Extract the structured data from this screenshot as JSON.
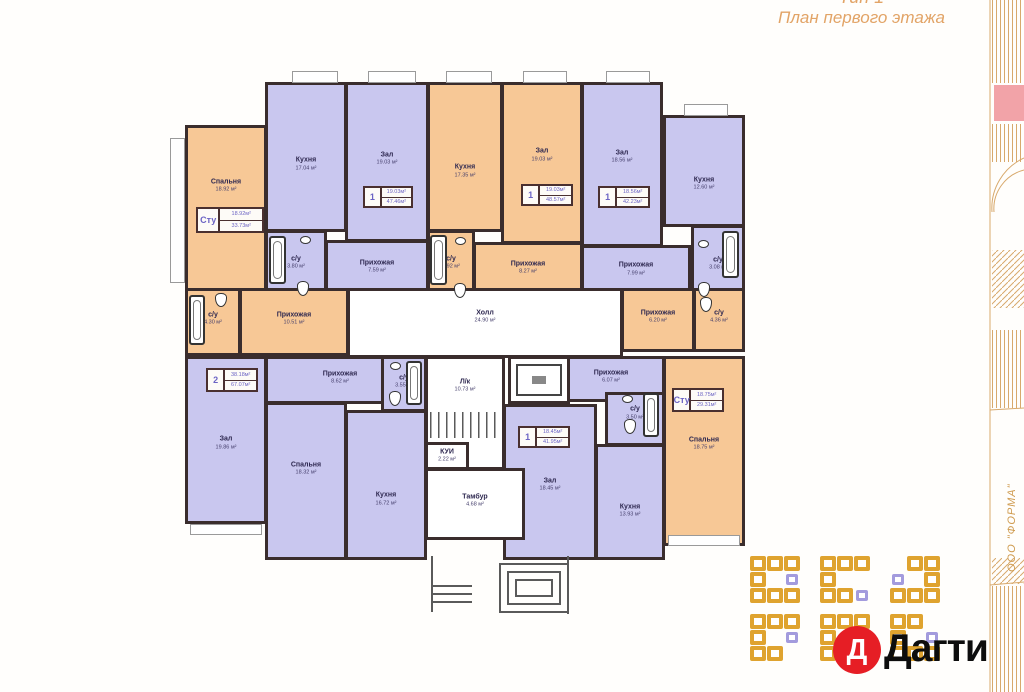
{
  "title": {
    "type_label": "Тип 1",
    "plan_label": "План первого этажа"
  },
  "frame": {
    "company": "ООО \"ФОРМА\""
  },
  "logo": {
    "letter": "Д",
    "name": "Дагти"
  },
  "colors": {
    "room_purple": "#c9c7ef",
    "room_orange": "#f7c896",
    "wall": "#3a2d2d",
    "title_orange": "#e2a467",
    "logo_red": "#e61e25",
    "frame_line": "#d8a96c",
    "frame_pink": "#f2a3a8",
    "unit_text": "#6b63c4"
  },
  "plan": {
    "rooms": [
      {
        "name": "Спальня",
        "area": "18.92 м²",
        "color": "orange",
        "x": 185,
        "y": 125,
        "w": 82,
        "h": 172,
        "ly": 0.35
      },
      {
        "name": "Кухня",
        "area": "17.04 м²",
        "color": "purple",
        "x": 265,
        "y": 82,
        "w": 82,
        "h": 150,
        "ly": 0.55
      },
      {
        "name": "Зал",
        "area": "19.03 м²",
        "color": "purple",
        "x": 345,
        "y": 82,
        "w": 84,
        "h": 160,
        "ly": 0.48
      },
      {
        "name": "Кухня",
        "area": "17.35 м²",
        "color": "orange",
        "x": 427,
        "y": 82,
        "w": 76,
        "h": 150,
        "ly": 0.6
      },
      {
        "name": "Зал",
        "area": "19.03 м²",
        "color": "orange",
        "x": 501,
        "y": 82,
        "w": 82,
        "h": 162,
        "ly": 0.45
      },
      {
        "name": "Зал",
        "area": "18.56 м²",
        "color": "purple",
        "x": 581,
        "y": 82,
        "w": 82,
        "h": 165,
        "ly": 0.45
      },
      {
        "name": "Кухня",
        "area": "12.60 м²",
        "color": "purple",
        "x": 663,
        "y": 115,
        "w": 82,
        "h": 112,
        "ly": 0.62
      },
      {
        "name": "с/у",
        "area": "3.80 м²",
        "color": "purple",
        "x": 265,
        "y": 230,
        "w": 62,
        "h": 72,
        "ly": 0.45
      },
      {
        "name": "Прихожая",
        "area": "7.59 м²",
        "color": "purple",
        "x": 325,
        "y": 240,
        "w": 104,
        "h": 62,
        "ly": 0.42
      },
      {
        "name": "с/у",
        "area": "3.92 м²",
        "color": "orange",
        "x": 427,
        "y": 230,
        "w": 48,
        "h": 72,
        "ly": 0.45
      },
      {
        "name": "Прихожая",
        "area": "8.27 м²",
        "color": "orange",
        "x": 473,
        "y": 242,
        "w": 110,
        "h": 60,
        "ly": 0.42
      },
      {
        "name": "Прихожая",
        "area": "7.99 м²",
        "color": "purple",
        "x": 581,
        "y": 245,
        "w": 110,
        "h": 57,
        "ly": 0.42
      },
      {
        "name": "с/у",
        "area": "3.08 м²",
        "color": "purple",
        "x": 691,
        "y": 225,
        "w": 54,
        "h": 77,
        "ly": 0.5
      },
      {
        "name": "с/у",
        "area": "4.30 м²",
        "color": "orange",
        "x": 185,
        "y": 288,
        "w": 56,
        "h": 68,
        "ly": 0.45
      },
      {
        "name": "Прихожая",
        "area": "10.51 м²",
        "color": "orange",
        "x": 239,
        "y": 288,
        "w": 110,
        "h": 68,
        "ly": 0.45
      },
      {
        "name": "Холл",
        "area": "24.90 м²",
        "color": "white",
        "x": 347,
        "y": 288,
        "w": 276,
        "h": 70,
        "ly": 0.4
      },
      {
        "name": "Прихожая",
        "area": "6.20 м²",
        "color": "orange",
        "x": 621,
        "y": 288,
        "w": 74,
        "h": 64,
        "ly": 0.45
      },
      {
        "name": "с/у",
        "area": "4.36 м²",
        "color": "orange",
        "x": 693,
        "y": 288,
        "w": 52,
        "h": 64,
        "ly": 0.45
      },
      {
        "name": "Зал",
        "area": "19.86 м²",
        "color": "purple",
        "x": 185,
        "y": 356,
        "w": 82,
        "h": 168,
        "ly": 0.52
      },
      {
        "name": "Прихожая",
        "area": "8.62 м²",
        "color": "purple",
        "x": 265,
        "y": 356,
        "w": 150,
        "h": 48,
        "ly": 0.45
      },
      {
        "name": "с/у",
        "area": "3.55 м²",
        "color": "purple",
        "x": 381,
        "y": 356,
        "w": 46,
        "h": 56,
        "ly": 0.45
      },
      {
        "name": "Спальня",
        "area": "18.32 м²",
        "color": "purple",
        "x": 265,
        "y": 402,
        "w": 82,
        "h": 158,
        "ly": 0.42
      },
      {
        "name": "Кухня",
        "area": "16.72 м²",
        "color": "purple",
        "x": 345,
        "y": 410,
        "w": 82,
        "h": 150,
        "ly": 0.6
      },
      {
        "name": "Л/к",
        "area": "10.73 м²",
        "color": "white",
        "x": 425,
        "y": 356,
        "w": 80,
        "h": 114,
        "ly": 0.25
      },
      {
        "name": "Прихожая",
        "area": "6.07 м²",
        "color": "purple",
        "x": 557,
        "y": 356,
        "w": 108,
        "h": 46,
        "ly": 0.45
      },
      {
        "name": "с/у",
        "area": "3.50 м²",
        "color": "purple",
        "x": 605,
        "y": 392,
        "w": 60,
        "h": 54,
        "ly": 0.38
      },
      {
        "name": "Зал",
        "area": "18.45 м²",
        "color": "purple",
        "x": 503,
        "y": 404,
        "w": 94,
        "h": 156,
        "ly": 0.52
      },
      {
        "name": "Кухня",
        "area": "13.93 м²",
        "color": "purple",
        "x": 595,
        "y": 444,
        "w": 70,
        "h": 116,
        "ly": 0.58
      },
      {
        "name": "Спальня",
        "area": "18.75 м²",
        "color": "orange",
        "x": 663,
        "y": 356,
        "w": 82,
        "h": 190,
        "ly": 0.46
      },
      {
        "name": "КУИ",
        "area": "2.22 м²",
        "color": "white",
        "x": 425,
        "y": 442,
        "w": 44,
        "h": 28,
        "ly": 0.5
      },
      {
        "name": "Тамбур",
        "area": "4.68 м²",
        "color": "white",
        "x": 425,
        "y": 468,
        "w": 100,
        "h": 72,
        "ly": 0.45
      }
    ],
    "unit_boxes": [
      {
        "label": "Сту",
        "a1": "18.92м²",
        "a2": "33.73м²",
        "x": 196,
        "y": 207,
        "w": 68,
        "h": 26
      },
      {
        "label": "1",
        "a1": "19.03м²",
        "a2": "47.46м²",
        "x": 363,
        "y": 186,
        "w": 50,
        "h": 22
      },
      {
        "label": "1",
        "a1": "19.03м²",
        "a2": "48.57м²",
        "x": 521,
        "y": 184,
        "w": 52,
        "h": 22
      },
      {
        "label": "1",
        "a1": "18.56м²",
        "a2": "42.23м²",
        "x": 598,
        "y": 186,
        "w": 52,
        "h": 22
      },
      {
        "label": "2",
        "a1": "38.18м²",
        "a2": "67.07м²",
        "x": 206,
        "y": 368,
        "w": 52,
        "h": 24
      },
      {
        "label": "1",
        "a1": "18.45м²",
        "a2": "41.95м²",
        "x": 518,
        "y": 426,
        "w": 52,
        "h": 22
      },
      {
        "label": "Сту",
        "a1": "18.75м²",
        "a2": "29.31м²",
        "x": 672,
        "y": 388,
        "w": 52,
        "h": 24
      }
    ],
    "fixtures": [
      {
        "type": "tub",
        "x": 269,
        "y": 236,
        "w": 17,
        "h": 48
      },
      {
        "type": "tub",
        "x": 430,
        "y": 235,
        "w": 17,
        "h": 50
      },
      {
        "type": "tub",
        "x": 722,
        "y": 231,
        "w": 17,
        "h": 47
      },
      {
        "type": "tub",
        "x": 189,
        "y": 295,
        "w": 16,
        "h": 50
      },
      {
        "type": "tub",
        "x": 406,
        "y": 361,
        "w": 16,
        "h": 44
      },
      {
        "type": "tub",
        "x": 643,
        "y": 393,
        "w": 16,
        "h": 44
      },
      {
        "type": "toilet",
        "x": 297,
        "y": 281,
        "w": 12,
        "h": 15
      },
      {
        "type": "toilet",
        "x": 454,
        "y": 283,
        "w": 12,
        "h": 15
      },
      {
        "type": "toilet",
        "x": 698,
        "y": 282,
        "w": 12,
        "h": 15
      },
      {
        "type": "toilet",
        "x": 215,
        "y": 293,
        "w": 12,
        "h": 14
      },
      {
        "type": "toilet",
        "x": 389,
        "y": 391,
        "w": 12,
        "h": 15
      },
      {
        "type": "toilet",
        "x": 624,
        "y": 419,
        "w": 12,
        "h": 15
      },
      {
        "type": "toilet",
        "x": 700,
        "y": 297,
        "w": 12,
        "h": 15
      },
      {
        "type": "sink",
        "x": 300,
        "y": 236,
        "w": 11,
        "h": 8
      },
      {
        "type": "sink",
        "x": 455,
        "y": 237,
        "w": 11,
        "h": 8
      },
      {
        "type": "sink",
        "x": 698,
        "y": 240,
        "w": 11,
        "h": 8
      },
      {
        "type": "sink",
        "x": 390,
        "y": 362,
        "w": 11,
        "h": 8
      },
      {
        "type": "sink",
        "x": 622,
        "y": 395,
        "w": 11,
        "h": 8
      }
    ],
    "windows": [
      {
        "x": 292,
        "y": 71,
        "w": 46,
        "h": 12
      },
      {
        "x": 368,
        "y": 71,
        "w": 48,
        "h": 12
      },
      {
        "x": 446,
        "y": 71,
        "w": 46,
        "h": 12
      },
      {
        "x": 523,
        "y": 71,
        "w": 44,
        "h": 12
      },
      {
        "x": 606,
        "y": 71,
        "w": 44,
        "h": 12
      },
      {
        "x": 684,
        "y": 104,
        "w": 44,
        "h": 12
      },
      {
        "x": 170,
        "y": 138,
        "w": 15,
        "h": 145
      },
      {
        "x": 190,
        "y": 524,
        "w": 72,
        "h": 11
      },
      {
        "x": 668,
        "y": 535,
        "w": 72,
        "h": 11
      }
    ]
  }
}
